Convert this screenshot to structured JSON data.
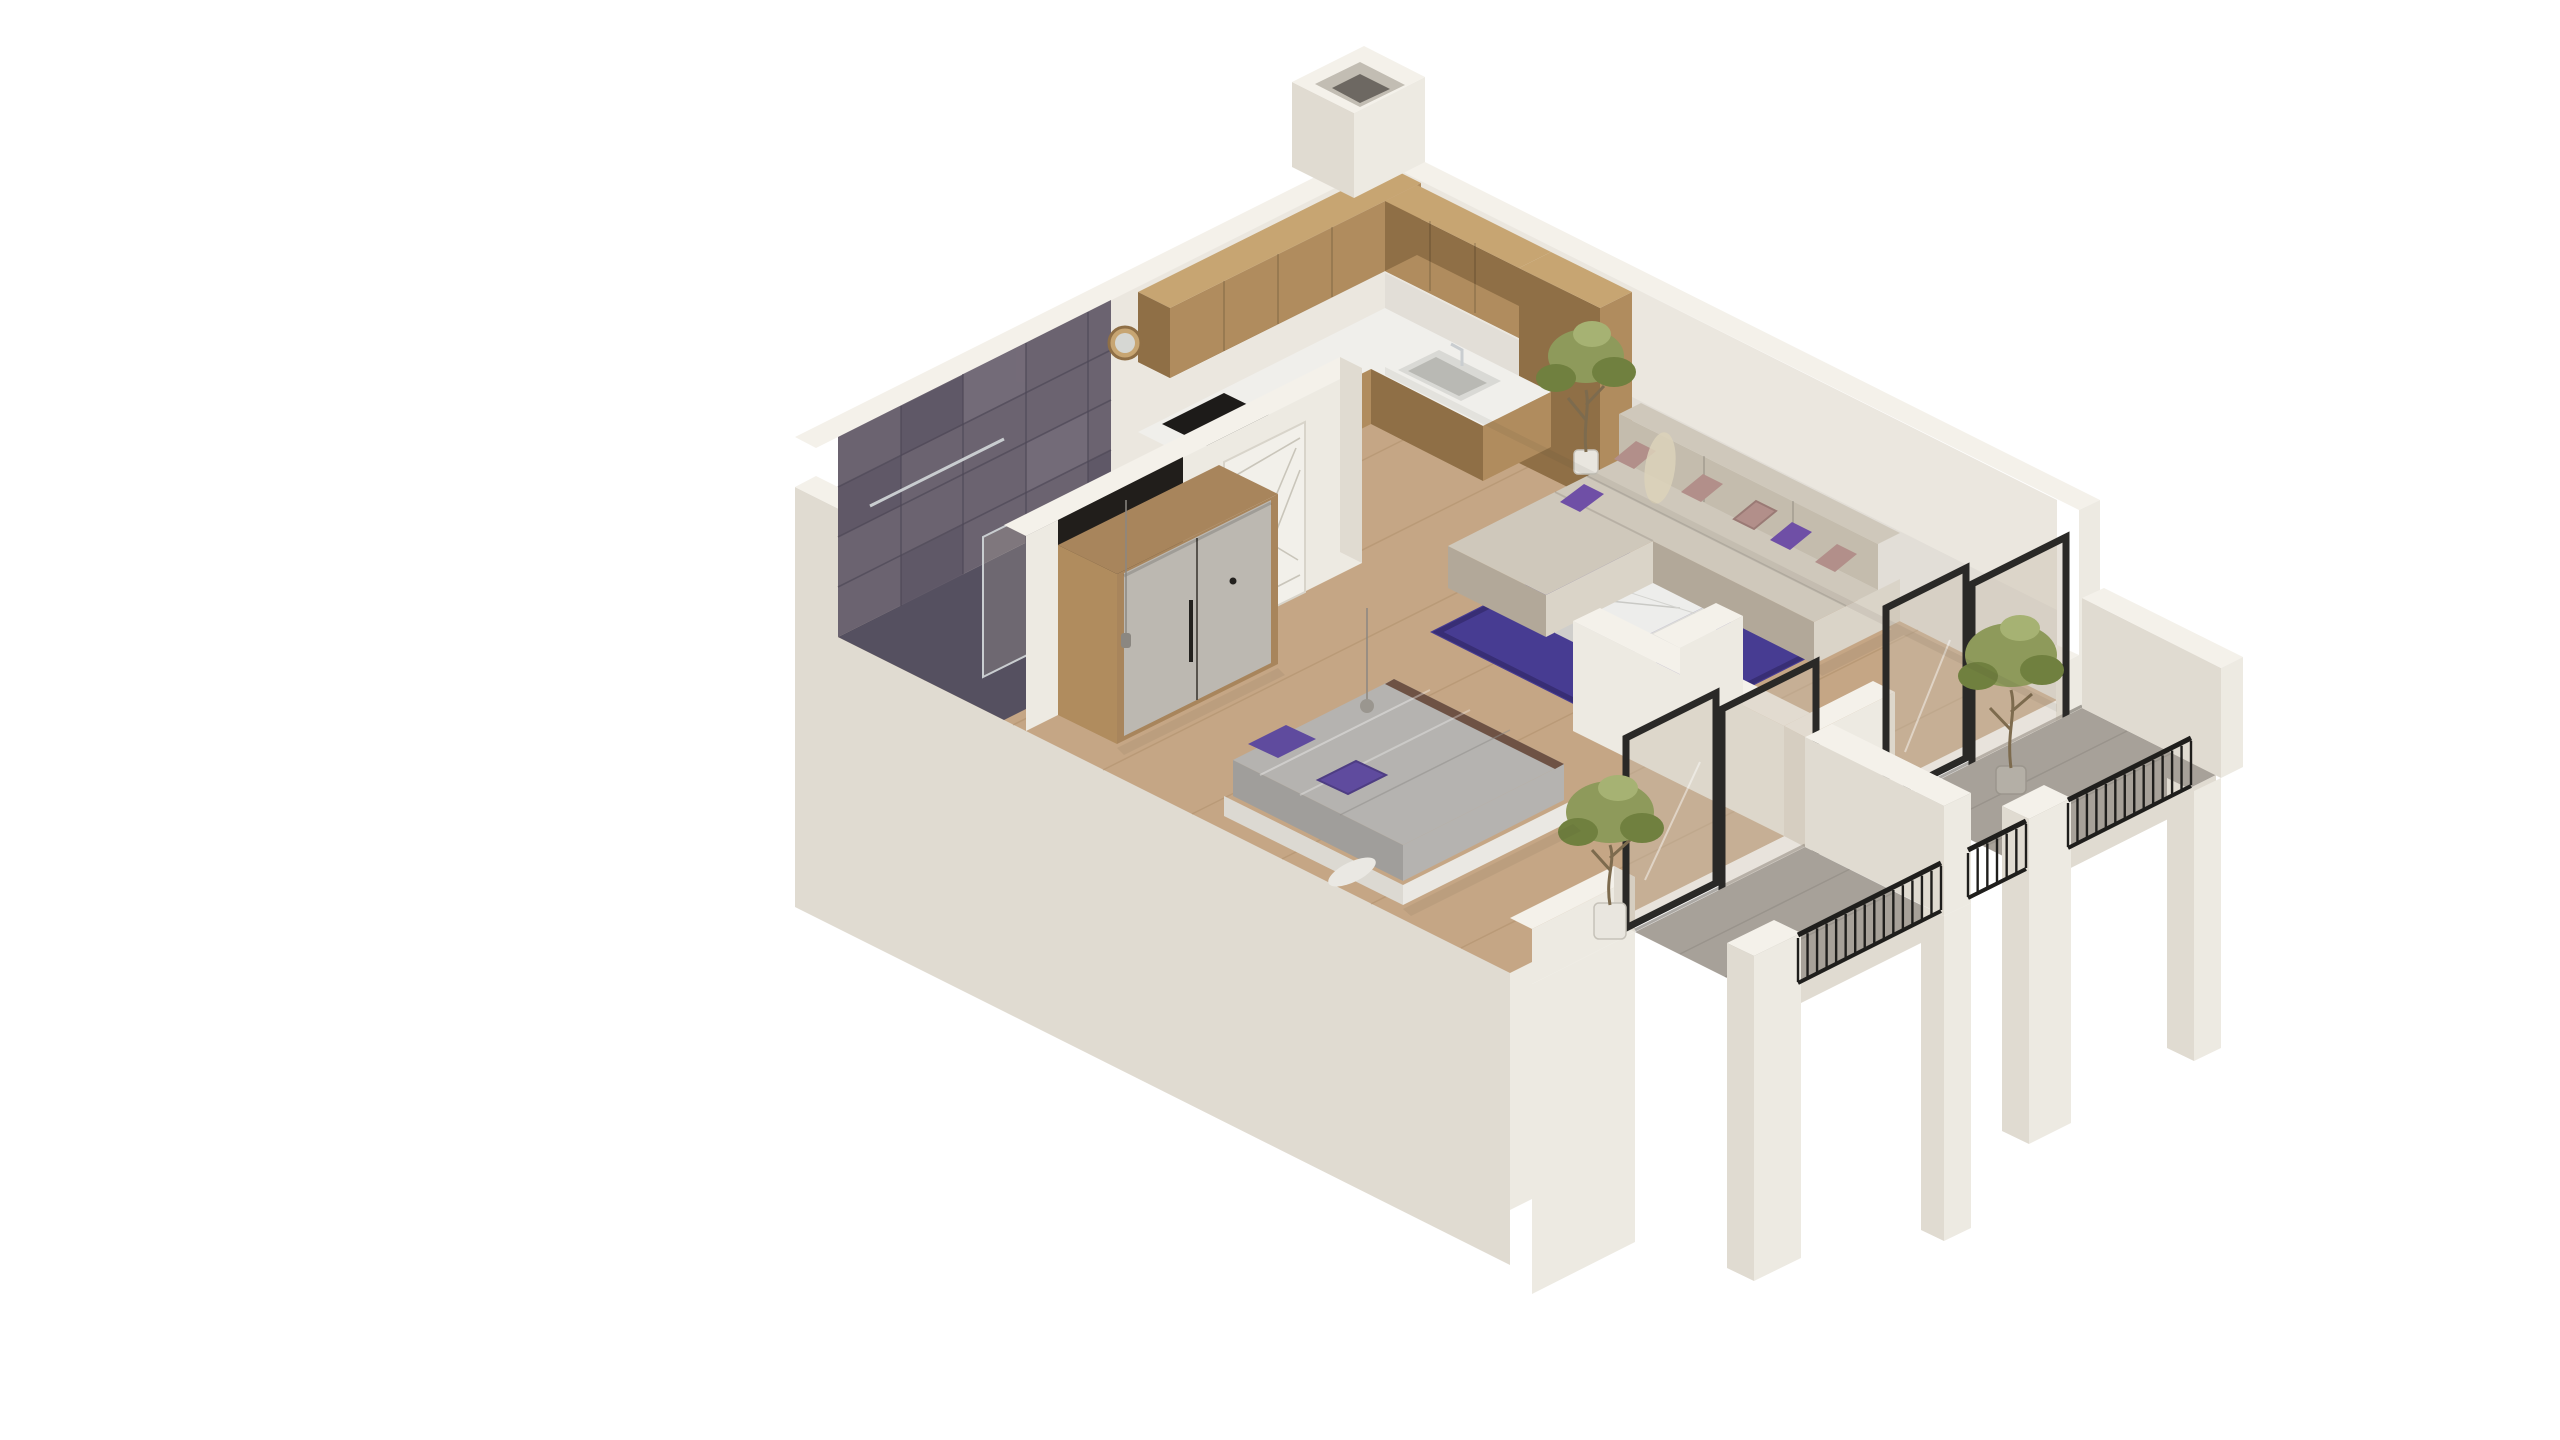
{
  "meta": {
    "kind": "3d-isometric-floorplan-render",
    "subject": "one-bedroom apartment cutaway",
    "background": "#ffffff",
    "visible_text": ""
  },
  "palette": {
    "bg": "#ffffff",
    "wallTop": "#f4f1ea",
    "facadeLight": "#edeae2",
    "facadeMid": "#e0dbd1",
    "facadeDark": "#d3cdc2",
    "wallInner": "#ebe7df",
    "wallInnerShade": "#dcd7ce",
    "tileBase": "#6b6370",
    "tileDark": "#575061",
    "tileLight": "#7b7280",
    "tileGrout": "#4e4857",
    "bathFloor": "#555060",
    "floorWood": "#c5a685",
    "floorLine": "#a5855f",
    "wood": "#b08c5e",
    "woodLight": "#c7a572",
    "woodDark": "#8f6f46",
    "woodFrame": "#a8855c",
    "counter": "#f0efeb",
    "cooktop": "#1d1b19",
    "sink": "#d9d9d5",
    "chrome": "#c9cdd0",
    "doorWhite": "#f2f0ea",
    "doorLine": "#c9c5ba",
    "handleDark": "#23211e",
    "wardrobeDoor": "#bcb8b1",
    "wardrobeGap": "#57534d",
    "nicheDark": "#211e1b",
    "sofa": "#cfc8bb",
    "sofaLight": "#dad4c8",
    "sofaDark": "#b2a899",
    "sofaBack": "#c4bcad",
    "pillowMauve": "#b28f8a",
    "pillowPurple": "#6f4fa6",
    "rug": "#473c92",
    "rugDark": "#382e75",
    "tableTop": "#ededeb",
    "tableSide": "#dddcd8",
    "tableSideD": "#cfcecb",
    "bedBase": "#eae8e3",
    "bedBaseD": "#dcd9d2",
    "duvet": "#b5b3b0",
    "duvetShade": "#a09e9b",
    "bedTrim": "#6e5244",
    "bedPillow": "#5f4b9e",
    "frameBlack": "#2a2927",
    "glass": "#c9bdac",
    "railBlack": "#1f1e1c",
    "balconyFloorGrey": "#a7a199",
    "potWhite": "#e9e6df",
    "potGrey": "#b4afa6",
    "treeG1": "#8e9a5b",
    "treeG2": "#70803f",
    "treeG3": "#a6b273",
    "trunk": "#7d6b4e",
    "pampas": "#dcd2ba"
  },
  "scene": {
    "view": "isometric cutaway from south",
    "rooms": [
      {
        "name": "bathroom",
        "position": "north-west corner",
        "features": [
          "dark purple-grey stone tile walls",
          "glass shower enclosure",
          "chrome towel bar",
          "white toilet",
          "window recess in left wall"
        ]
      },
      {
        "name": "hallway",
        "features": [
          "wood-framed wardrobe with grey doors and black pull",
          "white entry door with diagonal line decor and black handle",
          "dark wall niche",
          "pendant lamp on thin cord"
        ]
      },
      {
        "name": "kitchen",
        "position": "north corner",
        "features": [
          "L-shaped oak upper cabinets",
          "oak base cabinets",
          "white countertop",
          "dark cooktop",
          "inset sink with faucet",
          "round wood-framed mirror",
          "tall oak cabinet column"
        ]
      },
      {
        "name": "living-room",
        "position": "east",
        "features": [
          "beige L-shaped sectional sofa",
          "mauve and purple cushions",
          "deep purple rug",
          "white marble coffee table",
          "tall potted plant",
          "pampas grass"
        ]
      },
      {
        "name": "bedroom",
        "position": "south-west",
        "features": [
          "double bed with grey duvet",
          "brown blanket fold",
          "two purple pillows",
          "white platform frame",
          "pendant lamp"
        ]
      }
    ],
    "exterior": [
      {
        "name": "bedroom-balcony",
        "features": [
          "grey tile floor",
          "black vertical-bar railing",
          "olive tree in white pot",
          "cream parapet piers"
        ]
      },
      {
        "name": "living-balcony",
        "features": [
          "grey tile floor",
          "black vertical-bar railing",
          "olive tree in grey pot",
          "tall cream parapet wall"
        ]
      },
      {
        "name": "facade",
        "features": [
          "cream stucco walls",
          "white wall tops",
          "black framed sliding glass doors",
          "rooftop vent shaft at north corner"
        ]
      }
    ],
    "railings": [
      {
        "segment": "bedroom-balcony",
        "bars": 15
      },
      {
        "segment": "between-balconies",
        "bars": 6
      },
      {
        "segment": "living-balcony",
        "bars": 13
      }
    ]
  }
}
